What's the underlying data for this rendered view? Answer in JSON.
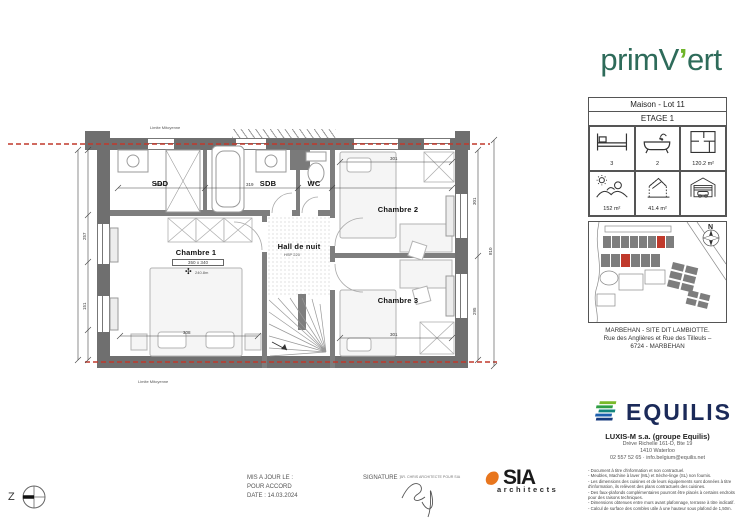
{
  "brand": {
    "pre": "primV",
    "apos": "’",
    "post": "ert"
  },
  "info_panel": {
    "title": "Maison - Lot 11",
    "subtitle": "ETAGE 1",
    "cells": [
      {
        "name": "bedrooms",
        "value": "3"
      },
      {
        "name": "bathrooms",
        "value": "2"
      },
      {
        "name": "floor-area",
        "value": "120.2 m²"
      },
      {
        "name": "garden-area",
        "value": "152 m²"
      },
      {
        "name": "volume-area",
        "value": "41.4 m²"
      },
      {
        "name": "garage",
        "value": ""
      }
    ]
  },
  "site": {
    "north": "N",
    "address1": "MARBEHAN - SITE DIT LAMBIOTTE.",
    "address2": "Rue des Anglières et Rue des Tilleuls –",
    "address3": "6724 - MARBEHAN"
  },
  "equilis": {
    "wordmark": "EQUILIS",
    "company": "LUXIS-M s.a. (groupe Equilis)",
    "address1": "Drève Richelle 161-D, Bte 19",
    "address2": "1410 Waterloo",
    "contact": "02 557 52 65 · info.belgium@equilis.net",
    "disclaimer": [
      "- Document à titre d'information et non contractuel.",
      "- Meubles, Machine à laver (ML) et Sèche-linge (SL) non fournis.",
      "- Les dimensions des cuisines et de leurs équipements sont données à titre",
      "  d'information, ils relèvent des plans contractuels des cuisines.",
      "- Des faux-plafonds complémentaires pourront être placés à certains endroits",
      "  pour des raisons techniques.",
      "- Dimensions obtenues entre murs avant plafonnage, terrasse à titre indicatif.",
      "- Calcul de surface des combles utile à une hauteur sous plafond de 1,50m."
    ]
  },
  "plan": {
    "limite": "Limite Mitoyenne",
    "rooms": {
      "sdd": "SDD",
      "sdb": "SDB",
      "wc": "WC",
      "c1": "Chambre 1",
      "c2": "Chambre 2",
      "c3": "Chambre 3",
      "hall": "Hall de nuit"
    },
    "notes": {
      "c1_dim": "350 x 340",
      "c1_fan": "240.8m",
      "hall": "HSP 220"
    },
    "dims": {
      "sdd": "320",
      "sdb": "319",
      "c1": "308",
      "c2": "301",
      "c3": "301",
      "left_a": "257",
      "left_b": "151",
      "right_a": "301",
      "right_b": "295",
      "total": "810"
    }
  },
  "footer": {
    "z": "Z",
    "updated": "MIS A JOUR LE :",
    "approval": "POUR ACCORD",
    "date": "DATE : 14.03.2024",
    "signature": "SIGNATURE :",
    "signature_note": "AR. CHRIS ARCHITECTE POUR SIA",
    "sia": "SIA",
    "sia_sub": "architects"
  },
  "colors": {
    "wall": "#6f6f6f",
    "party_line_red": "#c0392b",
    "primvert_green": "#2e6b5a",
    "primvert_accent": "#6fb52a",
    "equilis_navy": "#1b2a59",
    "sia_orange": "#e8761e"
  }
}
